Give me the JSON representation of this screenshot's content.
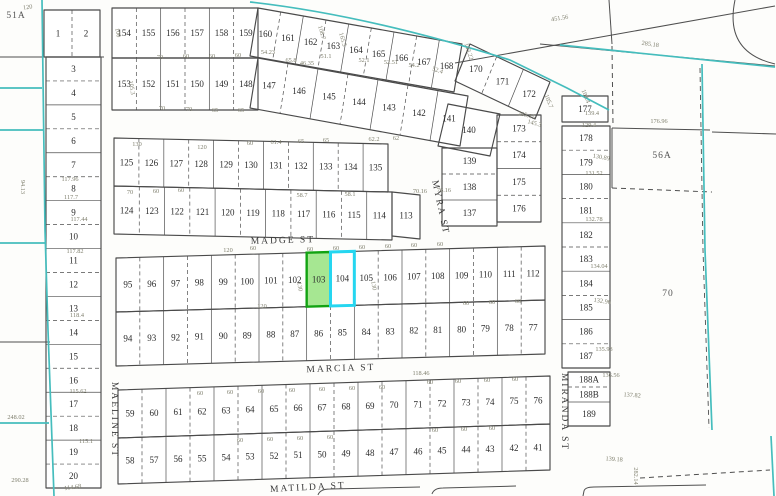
{
  "title": "Parcel plat map",
  "highlighted_lots": {
    "103": "green",
    "104": "cyan"
  },
  "map": {
    "width": 776,
    "height": 496,
    "line_color": "#4a4a4a",
    "teal_color": "#45bdbd",
    "green_fill": "#97e37f",
    "green_stroke": "#12a312",
    "cyan_stroke": "#25d6f0",
    "streets": [
      [
        "MADGE ST",
        283,
        243,
        -1.5
      ],
      [
        "MARCIA ST",
        341,
        371,
        -2
      ],
      [
        "MATILDA ST",
        308,
        490,
        -3
      ],
      [
        "MYRA ST",
        438,
        208,
        78
      ],
      [
        "MAELINE ST",
        112,
        420,
        90
      ],
      [
        "MIRANDA ST",
        562,
        412,
        90
      ]
    ],
    "parcel_labels": [
      [
        "51A",
        16,
        18
      ],
      [
        "56A",
        662,
        158
      ],
      [
        "70",
        668,
        296
      ]
    ],
    "strips": [
      {
        "id": "lots-1-2",
        "p0": [
          44,
          10
        ],
        "p1": [
          100,
          10
        ],
        "d": [
          0,
          47
        ],
        "lots": [
          "1",
          "2"
        ]
      },
      {
        "id": "left-col",
        "p0": [
          46,
          57
        ],
        "p1": [
          46,
          488
        ],
        "d": [
          55,
          0
        ],
        "lots": [
          "3",
          "4",
          "5",
          "6",
          "7",
          "8",
          "9",
          "10",
          "11",
          "12",
          "13",
          "14",
          "15",
          "16",
          "17",
          "18",
          "19",
          "20"
        ]
      },
      {
        "id": "top-row-a",
        "p0": [
          112,
          8
        ],
        "p1": [
          258,
          8
        ],
        "d": [
          0,
          50
        ],
        "lots": [
          "154",
          "155",
          "156",
          "157",
          "158",
          "159"
        ]
      },
      {
        "id": "top-row-a2",
        "p0": [
          258,
          8
        ],
        "p1": [
          462,
          44
        ],
        "d": [
          -8,
          48
        ],
        "lots": [
          "160",
          "161",
          "162",
          "163",
          "164",
          "165",
          "166",
          "167",
          "168"
        ]
      },
      {
        "id": "top-row-b",
        "p0": [
          112,
          58
        ],
        "p1": [
          258,
          58
        ],
        "d": [
          0,
          52
        ],
        "lots": [
          "153",
          "152",
          "151",
          "150",
          "149",
          "148"
        ]
      },
      {
        "id": "top-row-b2",
        "p0": [
          258,
          58
        ],
        "p1": [
          468,
          96
        ],
        "d": [
          -8,
          50
        ],
        "lots": [
          "147",
          "146",
          "145",
          "144",
          "143",
          "142",
          "141"
        ]
      },
      {
        "id": "lot-140",
        "p0": [
          448,
          104
        ],
        "p1": [
          500,
          114
        ],
        "d": [
          -10,
          42
        ],
        "lots": [
          "140"
        ]
      },
      {
        "id": "fan-170",
        "p0": [
          470,
          44
        ],
        "p1": [
          550,
          82
        ],
        "d": [
          -15,
          37
        ],
        "lots": [
          "170",
          "171",
          "172"
        ]
      },
      {
        "id": "mid-row-a",
        "p0": [
          114,
          138
        ],
        "p1": [
          388,
          144
        ],
        "d": [
          0,
          48
        ],
        "lots": [
          "125",
          "126",
          "127",
          "128",
          "129",
          "130",
          "131",
          "132",
          "133",
          "134",
          "135"
        ]
      },
      {
        "id": "mid-row-b",
        "p0": [
          114,
          186
        ],
        "p1": [
          392,
          192
        ],
        "d": [
          0,
          48
        ],
        "lots": [
          "124",
          "123",
          "122",
          "121",
          "120",
          "119",
          "118",
          "117",
          "116",
          "115",
          "114"
        ]
      },
      {
        "id": "lot-113",
        "p0": [
          392,
          192
        ],
        "p1": [
          420,
          195
        ],
        "d": [
          0,
          44
        ],
        "lots": [
          "113"
        ]
      },
      {
        "id": "myra-col",
        "p0": [
          442,
          148
        ],
        "p1": [
          442,
          226
        ],
        "d": [
          55,
          0
        ],
        "lots": [
          "139",
          "138",
          "137"
        ]
      },
      {
        "id": "col-173",
        "p0": [
          497,
          115
        ],
        "p1": [
          497,
          222
        ],
        "d": [
          44,
          0
        ],
        "lots": [
          "173",
          "174",
          "175",
          "176"
        ]
      },
      {
        "id": "lot-177",
        "p0": [
          562,
          96
        ],
        "p1": [
          562,
          122
        ],
        "d": [
          46,
          0
        ],
        "lots": [
          "177"
        ]
      },
      {
        "id": "right-col",
        "p0": [
          562,
          126
        ],
        "p1": [
          562,
          368
        ],
        "d": [
          48,
          0
        ],
        "lots": [
          "178",
          "179",
          "180",
          "181",
          "182",
          "183",
          "184",
          "185",
          "186",
          "187"
        ]
      },
      {
        "id": "col-188",
        "p0": [
          568,
          372
        ],
        "p1": [
          568,
          426
        ],
        "d": [
          42,
          0
        ],
        "lots": [
          {
            "n": "188A",
            "w": 1
          },
          {
            "n": "188B",
            "w": 1
          },
          {
            "n": "189",
            "w": 1.6
          }
        ]
      },
      {
        "id": "madge-row",
        "p0": [
          116,
          258
        ],
        "p1": [
          545,
          246
        ],
        "d": [
          0,
          54
        ],
        "lots": [
          "95",
          "96",
          "97",
          "98",
          "99",
          "100",
          "101",
          "102",
          "103",
          "104",
          "105",
          "106",
          "107",
          "108",
          "109",
          "110",
          "111",
          "112"
        ]
      },
      {
        "id": "madge-row-s",
        "p0": [
          116,
          312
        ],
        "p1": [
          545,
          300
        ],
        "d": [
          0,
          54
        ],
        "lots": [
          "94",
          "93",
          "92",
          "91",
          "90",
          "89",
          "88",
          "87",
          "86",
          "85",
          "84",
          "83",
          "82",
          "81",
          "80",
          "79",
          "78",
          "77"
        ]
      },
      {
        "id": "marcia-row",
        "p0": [
          118,
          390
        ],
        "p1": [
          550,
          376
        ],
        "d": [
          0,
          48
        ],
        "lots": [
          "59",
          "60",
          "61",
          "62",
          "63",
          "64",
          "65",
          "66",
          "67",
          "68",
          "69",
          "70",
          "71",
          "72",
          "73",
          "74",
          "75",
          "76"
        ]
      },
      {
        "id": "matilda-row",
        "p0": [
          118,
          438
        ],
        "p1": [
          550,
          424
        ],
        "d": [
          0,
          46
        ],
        "lots": [
          "58",
          "57",
          "56",
          "55",
          "54",
          "53",
          "52",
          "51",
          "50",
          "49",
          "48",
          "47",
          "46",
          "45",
          "44",
          "43",
          "42",
          "41"
        ]
      }
    ],
    "dark_lines": [
      {
        "d": "M0,57 L104,57"
      },
      {
        "d": "M455,63 L775,6"
      },
      {
        "d": "M540,44 L775,66"
      },
      {
        "d": "M609,0 L612,44"
      },
      {
        "d": "M612,46 L613,126",
        "dash": true
      },
      {
        "d": "M612,128 L710,130"
      },
      {
        "d": "M712,132 L776,134"
      },
      {
        "d": "M735,0 Q724,52 775,64"
      },
      {
        "d": "M612,188 L712,192",
        "dash": true
      },
      {
        "d": "M612,128 L612,188"
      },
      {
        "d": "M640,478 L770,470",
        "dash": true
      },
      {
        "d": "M583,496 L584,491 Q585,487 594,487 L706,485"
      },
      {
        "d": "M318,495 Q320,489 330,489 L420,487"
      },
      {
        "d": "M432,494 Q434,488 443,488 L516,486"
      },
      {
        "d": "M0,342 L50,342"
      }
    ],
    "teal_lines": [
      {
        "d": "M250,2 C340,12 430,35 510,60 L567,88 L609,110"
      },
      {
        "d": "M560,45 L775,67"
      },
      {
        "d": "M702,64 L705,250 L712,430"
      },
      {
        "d": "M700,68 L703,250 L709,428",
        "dash": true
      },
      {
        "d": "M771,436 L774,496"
      },
      {
        "d": "M42,0 L45,230 L48,330 L54,496"
      },
      {
        "d": "M0,88 L42,88"
      },
      {
        "d": "M0,130 L44,130"
      },
      {
        "d": "M0,243 L46,243"
      },
      {
        "d": "M0,423 L49,423"
      }
    ],
    "dims": [
      [
        "451.56",
        560,
        20,
        -9
      ],
      [
        "285.18",
        650,
        46,
        8
      ],
      [
        "139.4",
        592,
        115,
        0
      ],
      [
        "129.4",
        589,
        127,
        0
      ],
      [
        "176.96",
        659,
        123,
        0
      ],
      [
        "105.7",
        547,
        102,
        68
      ],
      [
        "108.4",
        584,
        97,
        68
      ],
      [
        "205.15",
        526,
        117,
        14
      ],
      [
        "145.3",
        534,
        125,
        14
      ],
      [
        "143.22",
        467,
        52,
        72
      ],
      [
        "54.23",
        268,
        54,
        0
      ],
      [
        "65.8",
        291,
        62,
        0
      ],
      [
        "46.35",
        307,
        65,
        0
      ],
      [
        "51.1",
        326,
        58,
        0
      ],
      [
        "52.1",
        364,
        62,
        0
      ],
      [
        "52.51",
        391,
        64,
        0
      ],
      [
        "54.2",
        414,
        67,
        0
      ],
      [
        "52.4",
        437,
        72,
        18
      ],
      [
        "117.96",
        70,
        181,
        0
      ],
      [
        "117.7",
        71,
        199,
        0
      ],
      [
        "117.44",
        79,
        221,
        0
      ],
      [
        "117.82",
        75,
        253,
        0
      ],
      [
        "118.4",
        77,
        317,
        0
      ],
      [
        "115.62",
        78,
        393,
        0
      ],
      [
        "115.1",
        86,
        443,
        0
      ],
      [
        "114.68",
        73,
        489,
        -8
      ],
      [
        "94.13",
        21,
        187,
        90
      ],
      [
        "290.28",
        20,
        482,
        0
      ],
      [
        "248.02",
        16,
        419,
        0
      ],
      [
        "118.46",
        421,
        375,
        0
      ],
      [
        "130.89",
        601,
        159,
        10
      ],
      [
        "131.52",
        594,
        175,
        0
      ],
      [
        "132.78",
        594,
        221,
        0
      ],
      [
        "134.04",
        599,
        268,
        0
      ],
      [
        "132.96",
        602,
        303,
        8
      ],
      [
        "135.93",
        604,
        351,
        0
      ],
      [
        "136.56",
        611,
        377,
        0
      ],
      [
        "137.82",
        632,
        397,
        4
      ],
      [
        "139.18",
        614,
        461,
        4
      ],
      [
        "282.14",
        634,
        476,
        90
      ],
      [
        "120",
        28,
        9,
        -8
      ],
      [
        "100",
        116,
        33,
        80
      ],
      [
        "105.3",
        130,
        88,
        80
      ],
      [
        "108.7",
        320,
        33,
        75
      ],
      [
        "165.5",
        341,
        40,
        75
      ],
      [
        "130",
        137,
        146,
        0
      ],
      [
        "120",
        202,
        149,
        0
      ],
      [
        "60",
        250,
        145,
        0
      ],
      [
        "61.4",
        276,
        144,
        0
      ],
      [
        "65",
        301,
        143,
        0
      ],
      [
        "65",
        326,
        142,
        0
      ],
      [
        "62.2",
        374,
        141,
        0
      ],
      [
        "62",
        396,
        140,
        0
      ],
      [
        "70",
        130,
        194,
        0
      ],
      [
        "60",
        156,
        193,
        0
      ],
      [
        "60",
        181,
        192,
        0
      ],
      [
        "58.7",
        302,
        197,
        0
      ],
      [
        "58.1",
        350,
        196,
        0
      ],
      [
        "70.16",
        420,
        193,
        0
      ],
      [
        "76.16",
        444,
        192,
        0
      ],
      [
        "70",
        160,
        59,
        0
      ],
      [
        "60",
        186,
        58,
        0
      ],
      [
        "60",
        212,
        58,
        0
      ],
      [
        "60",
        238,
        57,
        0
      ],
      [
        "70",
        162,
        110,
        0
      ],
      [
        "70",
        189,
        111,
        0
      ],
      [
        "65",
        215,
        112,
        0
      ],
      [
        "65",
        241,
        112,
        0
      ],
      [
        "60",
        253,
        250,
        0
      ],
      [
        "60",
        310,
        251,
        0
      ],
      [
        "60",
        336,
        250,
        0
      ],
      [
        "60",
        362,
        249,
        0
      ],
      [
        "60",
        388,
        248,
        0
      ],
      [
        "60",
        414,
        247,
        0
      ],
      [
        "60",
        440,
        246,
        0
      ],
      [
        "120",
        228,
        252,
        0
      ],
      [
        "60",
        466,
        305,
        0
      ],
      [
        "60",
        492,
        304,
        0
      ],
      [
        "60",
        518,
        303,
        0
      ],
      [
        "120",
        262,
        308,
        0
      ],
      [
        "130",
        298,
        287,
        80
      ],
      [
        "130",
        372,
        286,
        80
      ],
      [
        "60",
        200,
        395,
        0
      ],
      [
        "60",
        230,
        394,
        0
      ],
      [
        "60",
        261,
        393,
        0
      ],
      [
        "60",
        292,
        392,
        0
      ],
      [
        "60",
        322,
        391,
        0
      ],
      [
        "60",
        352,
        390,
        0
      ],
      [
        "60",
        382,
        389,
        0
      ],
      [
        "60",
        430,
        384,
        0
      ],
      [
        "60",
        458,
        383,
        0
      ],
      [
        "60",
        487,
        382,
        0
      ],
      [
        "60",
        515,
        381,
        0
      ],
      [
        "60",
        240,
        442,
        0
      ],
      [
        "60",
        270,
        441,
        0
      ],
      [
        "60",
        300,
        440,
        0
      ],
      [
        "60",
        330,
        439,
        0
      ],
      [
        "60",
        435,
        432,
        0
      ],
      [
        "60",
        464,
        431,
        0
      ],
      [
        "60",
        492,
        430,
        0
      ]
    ]
  }
}
